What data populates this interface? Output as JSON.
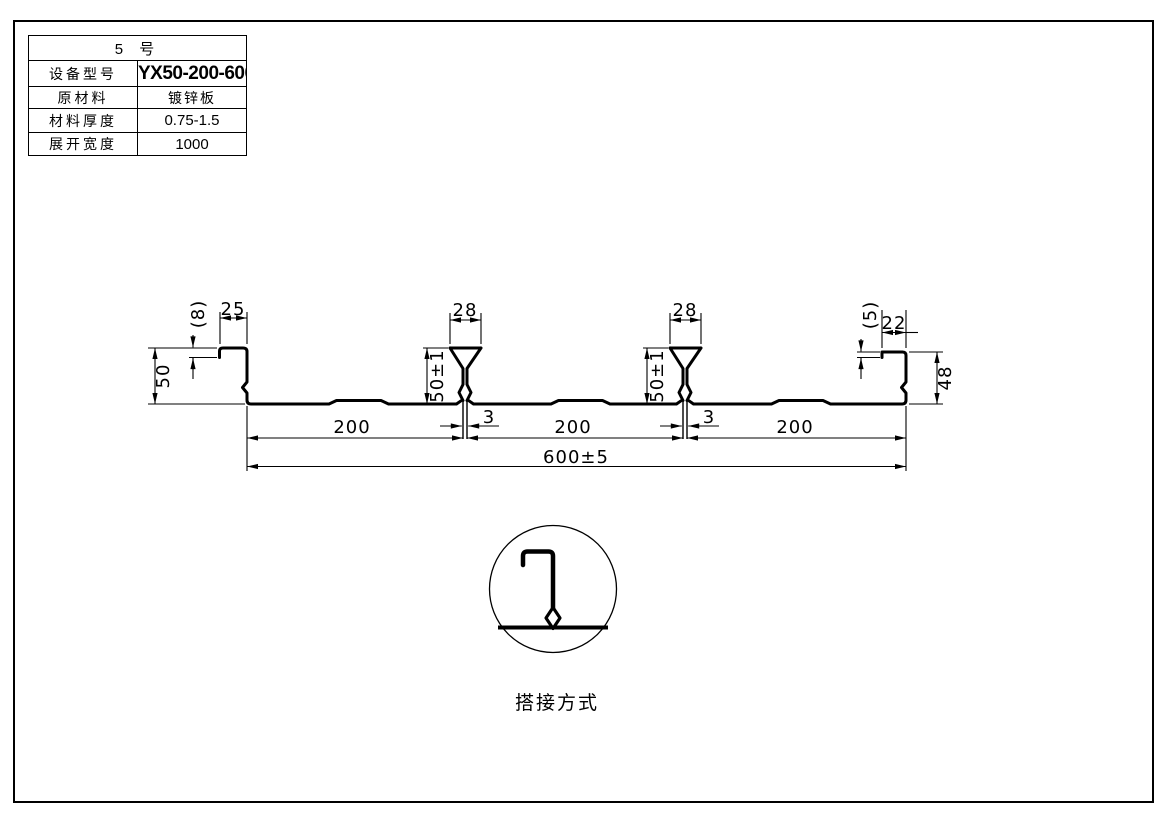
{
  "table": {
    "title": "5 号",
    "rows": [
      {
        "label": "设备型号",
        "value": "YX50-200-600"
      },
      {
        "label": "原材料",
        "value": "镀锌板"
      },
      {
        "label": "材料厚度",
        "value": "0.75-1.5"
      },
      {
        "label": "展开宽度",
        "value": "1000"
      }
    ]
  },
  "drawing": {
    "dims": {
      "left_lip": "(8)",
      "left_flange": "25",
      "left_height": "50",
      "rib1_top": "28",
      "rib1_height": "50±1",
      "rib1_gap": "3",
      "rib2_top": "28",
      "rib2_height": "50±1",
      "rib2_gap": "3",
      "right_lip": "(5)",
      "right_flange": "22",
      "right_height": "48",
      "pan1": "200",
      "pan2": "200",
      "pan3": "200",
      "overall": "600±5"
    },
    "caption": "搭接方式"
  }
}
